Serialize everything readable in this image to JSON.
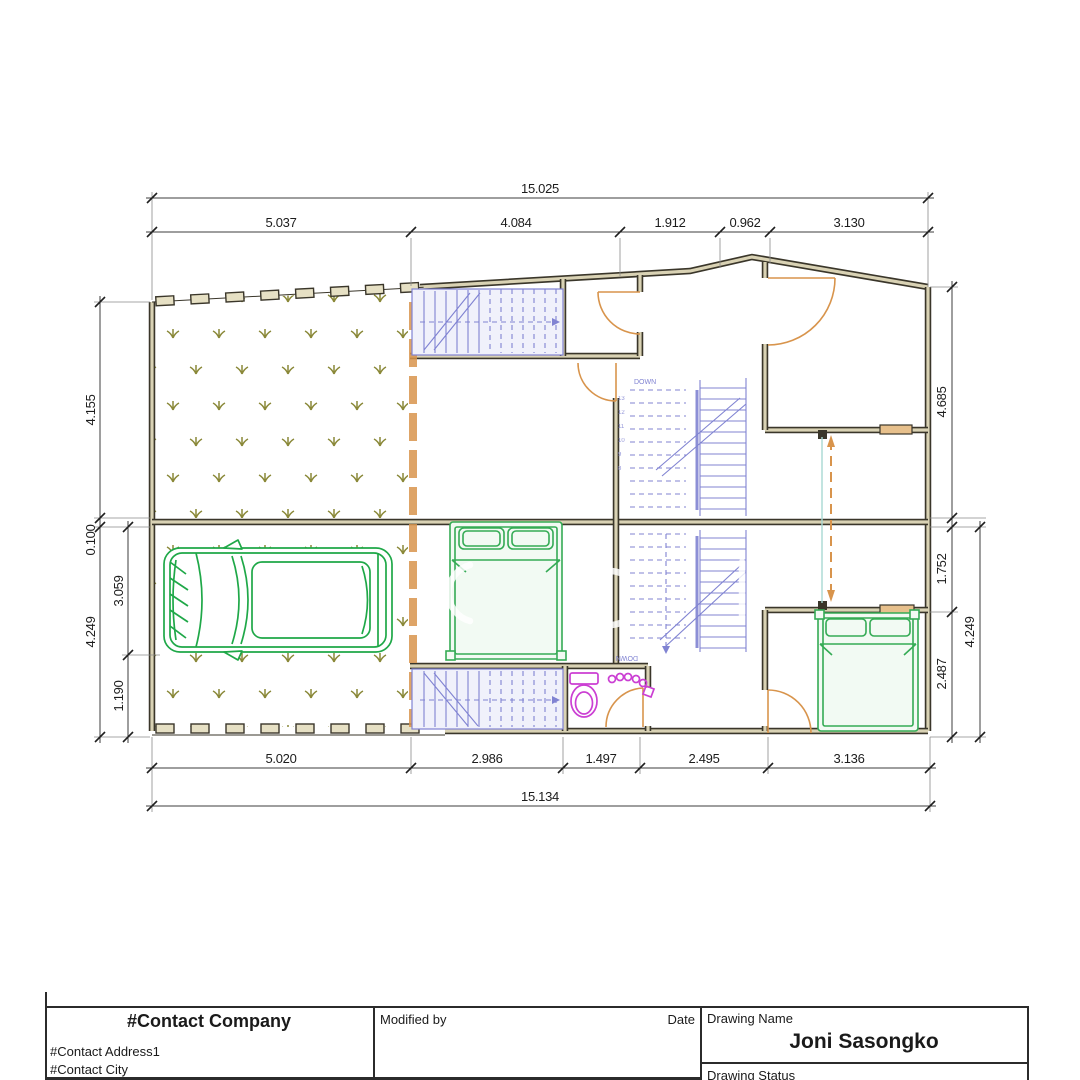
{
  "palette": {
    "wall": "#3a362a",
    "wall_fill": "#d9d2b4",
    "fence_fill": "#e6e0c4",
    "orange": "#d8944c",
    "window_fill": "#e7c08c",
    "car_green": "#1fa848",
    "bed_green": "#35ab55",
    "stair_blue": "#8083d2",
    "stair_fill": "#f0f1fb",
    "magenta": "#cb3fd3",
    "olive": "#8a8838",
    "teal": "#a8d8d2",
    "dim_line": "#3c3c3c",
    "dim_text": "#1c1c1c",
    "tb_line": "#2b2b2b"
  },
  "dimensions": {
    "top": {
      "total": "15.025",
      "segments": [
        "5.037",
        "4.084",
        "1.912",
        "0.962",
        "3.130"
      ]
    },
    "bottom": {
      "total": "15.134",
      "segments": [
        "5.020",
        "2.986",
        "1.497",
        "2.495",
        "3.136"
      ]
    },
    "left": {
      "outer_top": "4.155",
      "gap": "0.100",
      "outer_bottom": "4.249",
      "inner_top": "3.059",
      "inner_bottom": "1.190"
    },
    "right": {
      "outer_top": "4.685",
      "mid": "1.752",
      "lower": "2.487",
      "outer_bottom": "4.249"
    }
  },
  "stairs": {
    "down_label_upper": "DOWN",
    "down_label_lower": "DOWN",
    "step_numbers": [
      "13",
      "12",
      "11",
      "10",
      "9",
      "8"
    ]
  },
  "title_block": {
    "company": "#Contact Company",
    "address1": "#Contact Address1",
    "city": "#Contact City",
    "modified_by_label": "Modified by",
    "date_label": "Date",
    "drawing_name_label": "Drawing Name",
    "drawing_name": "Joni Sasongko",
    "drawing_status_label": "Drawing Status"
  }
}
